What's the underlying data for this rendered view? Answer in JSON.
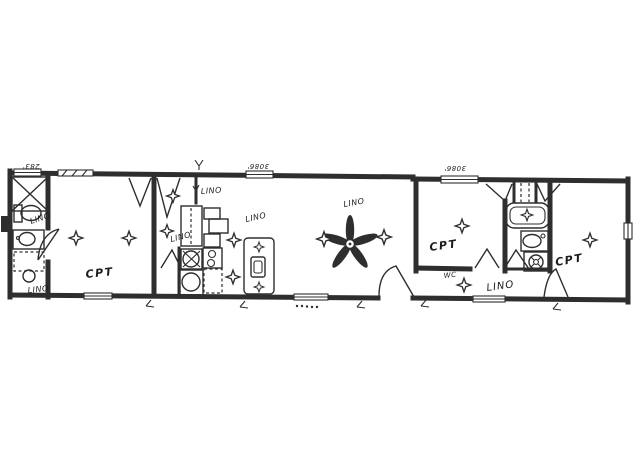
{
  "floor_plan": {
    "room_labels": {
      "bedroom_left": "CPT",
      "bedroom_middle": "CPT",
      "bedroom_right": "CPT",
      "bath_left": "LINO",
      "utility": "LINO",
      "hall_top": "LINO",
      "hall": "LINO",
      "kitchen": "LINO",
      "living": "LINO",
      "corridor": "LINO",
      "water_closet": "WC"
    },
    "window_size_labels": {
      "bath_left": "283'",
      "kitchen": "3086'",
      "bedroom_middle": "3086'"
    },
    "colors": {
      "ink": "#2e2e2e",
      "paper": "#ffffff"
    }
  }
}
